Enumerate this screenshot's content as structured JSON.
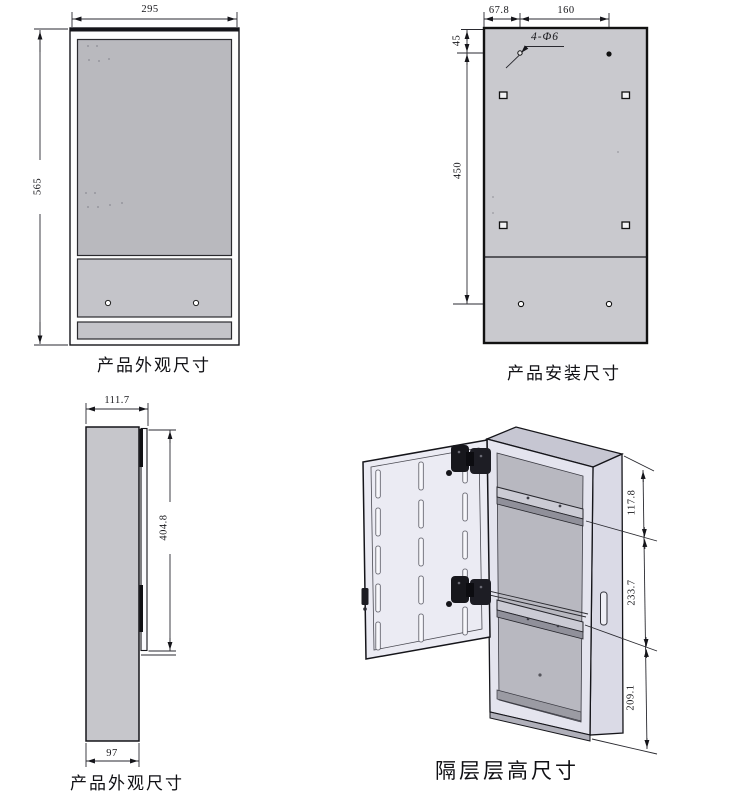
{
  "drawing": {
    "front_view": {
      "caption": "产品外观尺寸",
      "width": "295",
      "height": "565"
    },
    "mounting_view": {
      "caption": "产品安装尺寸",
      "top_hole_offset_x": "67.8",
      "hole_spacing_x": "160",
      "top_hole_offset_y": "45",
      "hole_spacing_y": "450",
      "hole_callout": "4-Φ6"
    },
    "side_view": {
      "caption": "产品外观尺寸",
      "depth_with_door": "111.7",
      "door_height": "404.8",
      "body_depth": "97"
    },
    "iso_view": {
      "caption": "隔层层高尺寸",
      "shelf_top_height": "117.8",
      "shelf_middle_height": "233.7",
      "shelf_bottom_height": "209.1"
    }
  },
  "colors": {
    "panel_gray": "#c6c6cb",
    "line": "#15151a",
    "background": "#ffffff"
  }
}
